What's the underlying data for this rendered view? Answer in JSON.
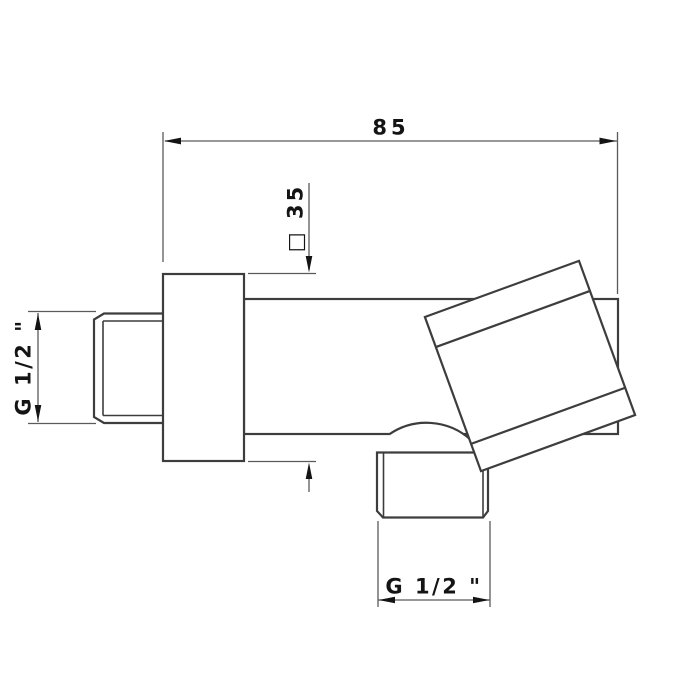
{
  "drawing": {
    "kind": "technical-dimension-drawing",
    "part": "wall-mounted water outlet elbow with square flange and knob",
    "dimensions": {
      "overall_length": "85",
      "flange_square": "□ 35",
      "inlet_thread": "G 1/2 \"",
      "outlet_thread": "G 1/2 \""
    }
  },
  "colors": {
    "background": "#ffffff",
    "object_line": "#3d3d3d",
    "dimension_line": "#5a5a5a",
    "text": "#141414"
  }
}
